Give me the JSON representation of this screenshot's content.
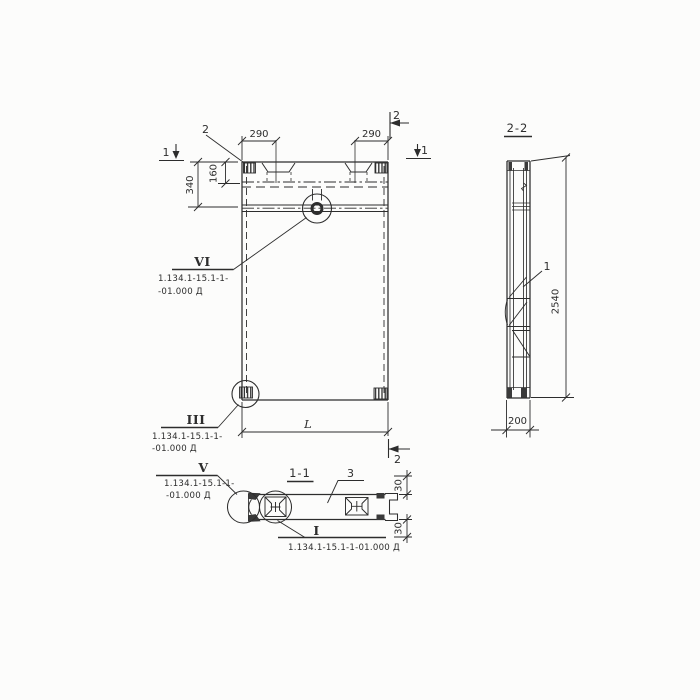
{
  "colors": {
    "ink": "#2d2d2d",
    "paper": "#fcfcfb"
  },
  "views": {
    "elevation": {
      "leader_label_2": "2",
      "dims": {
        "d290_left": "290",
        "d290_right": "290",
        "d340": "340",
        "d160": "160",
        "length": "L"
      },
      "marks": {
        "s1_left": "1",
        "s1_right": "1",
        "s2_top": "2",
        "s2_bottom": "2"
      }
    },
    "section22": {
      "title": "2-2",
      "leader_label_1": "1",
      "dims": {
        "height": "2540",
        "width": "200"
      }
    },
    "section11": {
      "title": "1-1",
      "leader_label_3": "3",
      "dims": {
        "t30_top": "30",
        "t30_bottom": "30"
      }
    }
  },
  "callouts": {
    "vi": {
      "numeral": "VI",
      "ref1": "1.134.1-15.1-1-",
      "ref2": "-01.000 Д"
    },
    "iii": {
      "numeral": "III",
      "ref1": "1.134.1-15.1-1-",
      "ref2": "-01.000 Д"
    },
    "v": {
      "numeral": "V",
      "ref1": "1.134.1-15.1-1-",
      "ref2": "-01.000 Д"
    },
    "i": {
      "numeral": "I",
      "ref": "1.134.1-15.1-1-01.000 Д"
    }
  }
}
